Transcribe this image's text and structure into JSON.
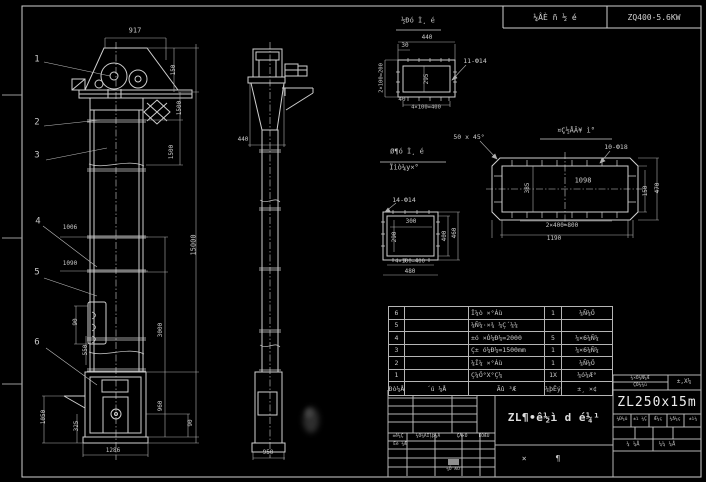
{
  "header": {
    "center_label": "¼ÂÈ ñ ½ é",
    "right_label": "ZQ400-5.6KW"
  },
  "titleblock": {
    "model": "ZL250x15m",
    "name": "ZL¶•ê½ì d é¼¹"
  },
  "bom": {
    "header": [
      "Ðò¼Å",
      "´ú ¼Å",
      "Ãû ³Æ",
      "¼þÊý",
      "±¸ ×¢"
    ],
    "rows": [
      [
        "6",
        "",
        "Î¼ò ×°Áù",
        "1",
        "¼Ñ¼Ö"
      ],
      [
        "5",
        "",
        "¼Ñ¼·×¾ ¼Ç´¼¼",
        "",
        ""
      ],
      [
        "4",
        "",
        "±ó ×Ó¼Ð¼=2000",
        "5",
        "¼×6¼Ñ¼"
      ],
      [
        "3",
        "",
        "Ç± ó¼Ð¼=1500mm",
        "1",
        "¼×6¼Ñ¼"
      ],
      [
        "2",
        "",
        "¼Î¼ ×°Áù",
        "1",
        "¼Ñ¼Ö"
      ],
      [
        "1",
        "",
        "Ç¼Ö°X°Ç¼",
        "1X",
        "¼ó¼Æ°"
      ]
    ]
  },
  "labels": [
    {
      "n": "dim-917",
      "t": "917",
      "x": 135,
      "y": 31,
      "s": 7
    },
    {
      "n": "dim-150",
      "t": "150",
      "x": 174,
      "y": 70,
      "r": 1,
      "s": 6
    },
    {
      "n": "dim-1500-a",
      "t": "1500",
      "x": 180,
      "y": 108,
      "r": 1,
      "s": 6
    },
    {
      "n": "dim-1500-b",
      "t": "1500",
      "x": 172,
      "y": 152,
      "r": 1,
      "s": 6
    },
    {
      "n": "dim-15000",
      "t": "15000",
      "x": 194,
      "y": 245,
      "r": 1,
      "s": 7
    },
    {
      "n": "dim-3000",
      "t": "3000",
      "x": 161,
      "y": 330,
      "r": 1,
      "s": 6
    },
    {
      "n": "dim-960",
      "t": "960",
      "x": 161,
      "y": 406,
      "r": 1,
      "s": 6
    },
    {
      "n": "dim-90-boot",
      "t": "90",
      "x": 191,
      "y": 423,
      "r": 1,
      "s": 6
    },
    {
      "n": "dim-1006",
      "t": "1006",
      "x": 70,
      "y": 228,
      "s": 6
    },
    {
      "n": "dim-1090",
      "t": "1090",
      "x": 70,
      "y": 264,
      "s": 6
    },
    {
      "n": "dim-90-door",
      "t": "90",
      "x": 76,
      "y": 322,
      "r": 1,
      "s": 6
    },
    {
      "n": "dim-550",
      "t": "550",
      "x": 86,
      "y": 350,
      "r": 1,
      "s": 6
    },
    {
      "n": "dim-1050",
      "t": "1050",
      "x": 44,
      "y": 417,
      "r": 1,
      "s": 6
    },
    {
      "n": "dim-325",
      "t": "325",
      "x": 77,
      "y": 426,
      "r": 1,
      "s": 6
    },
    {
      "n": "dim-1286",
      "t": "1286",
      "x": 113,
      "y": 451,
      "s": 6
    },
    {
      "n": "dim-440-side",
      "t": "440",
      "x": 243,
      "y": 140,
      "s": 6
    },
    {
      "n": "dim-950",
      "t": "950",
      "x": 268,
      "y": 453,
      "s": 6
    },
    {
      "n": "dim-440-flange",
      "t": "440",
      "x": 427,
      "y": 38,
      "s": 6
    },
    {
      "n": "dim-30",
      "t": "30",
      "x": 405,
      "y": 46,
      "s": 6
    },
    {
      "n": "dim-2x100",
      "t": "2×100=200",
      "x": 382,
      "y": 78,
      "r": 1,
      "s": 5.5
    },
    {
      "n": "dim-295",
      "t": "295",
      "x": 427,
      "y": 79,
      "r": 1,
      "s": 6
    },
    {
      "n": "dim-40",
      "t": "40",
      "x": 402,
      "y": 100,
      "s": 6
    },
    {
      "n": "dim-4x100-a",
      "t": "4×100=400",
      "x": 426,
      "y": 108,
      "s": 5.5
    },
    {
      "n": "note-11-holes",
      "t": "11-Ф14",
      "x": 475,
      "y": 61,
      "s": 6.5
    },
    {
      "n": "note-14-holes",
      "t": "14-Ф14",
      "x": 404,
      "y": 200,
      "s": 6.5
    },
    {
      "n": "dim-300",
      "t": "300",
      "x": 411,
      "y": 222,
      "s": 6
    },
    {
      "n": "dim-290",
      "t": "290",
      "x": 395,
      "y": 237,
      "r": 1,
      "s": 6
    },
    {
      "n": "dim-400",
      "t": "400",
      "x": 445,
      "y": 236,
      "r": 1,
      "s": 6
    },
    {
      "n": "dim-460",
      "t": "460",
      "x": 455,
      "y": 233,
      "r": 1,
      "s": 6
    },
    {
      "n": "dim-4x100-b",
      "t": "4×100=400",
      "x": 410,
      "y": 262,
      "s": 5.5
    },
    {
      "n": "dim-480",
      "t": "480",
      "x": 410,
      "y": 272,
      "s": 6
    },
    {
      "n": "note-chamfer",
      "t": "50 x 45°",
      "x": 469,
      "y": 137,
      "s": 6.5
    },
    {
      "n": "note-10-holes",
      "t": "10-Ф18",
      "x": 616,
      "y": 147,
      "s": 6.5
    },
    {
      "n": "dim-1098",
      "t": "1098",
      "x": 583,
      "y": 181,
      "s": 7
    },
    {
      "n": "dim-385",
      "t": "385",
      "x": 528,
      "y": 188,
      "r": 1,
      "s": 6
    },
    {
      "n": "dim-150-inlet",
      "t": "150",
      "x": 646,
      "y": 191,
      "r": 1,
      "s": 6
    },
    {
      "n": "dim-470",
      "t": "470",
      "x": 658,
      "y": 188,
      "r": 1,
      "s": 6
    },
    {
      "n": "dim-2x400",
      "t": "2×400=800",
      "x": 562,
      "y": 226,
      "s": 6
    },
    {
      "n": "dim-1190",
      "t": "1190",
      "x": 554,
      "y": 239,
      "s": 6
    },
    {
      "n": "balloon-1",
      "t": "1",
      "x": 37,
      "y": 60,
      "s": 9
    },
    {
      "n": "balloon-2",
      "t": "2",
      "x": 37,
      "y": 123,
      "s": 9
    },
    {
      "n": "balloon-3",
      "t": "3",
      "x": 37,
      "y": 156,
      "s": 9
    },
    {
      "n": "balloon-4",
      "t": "4",
      "x": 38,
      "y": 222,
      "s": 9
    },
    {
      "n": "balloon-5",
      "t": "5",
      "x": 37,
      "y": 273,
      "s": 9
    },
    {
      "n": "balloon-6",
      "t": "6",
      "x": 37,
      "y": 343,
      "s": 9
    },
    {
      "n": "view-title-discharge",
      "t": "½Ðó Ì¸ é",
      "x": 418,
      "y": 21,
      "s": 7
    },
    {
      "n": "view-title-square-1",
      "t": "Ø¶ó Ì¸ é",
      "x": 407,
      "y": 152,
      "s": 7
    },
    {
      "n": "view-title-square-2",
      "t": "Ïìò¼y×°",
      "x": 404,
      "y": 168,
      "s": 7
    },
    {
      "n": "view-title-inlet",
      "t": "¤Ç½ÅÃ¥ ì°",
      "x": 576,
      "y": 131,
      "s": 7
    },
    {
      "n": "tb-cell-top-1",
      "t": "¼×Ö¼Ñ¼Æ",
      "x": 640,
      "y": 379,
      "s": 4.5
    },
    {
      "n": "tb-cell-top-2",
      "t": "ÇÕ¼¼ù",
      "x": 640,
      "y": 386,
      "s": 4.5
    },
    {
      "n": "tb-cell-top-3",
      "t": "±,X¼",
      "x": 684,
      "y": 382,
      "s": 6
    },
    {
      "n": "tb-small-1",
      "t": "¼Ð¼û",
      "x": 622,
      "y": 420,
      "s": 4.5
    },
    {
      "n": "tb-small-2",
      "t": "±ì ¼Ç",
      "x": 640,
      "y": 420,
      "s": 4.5
    },
    {
      "n": "tb-small-3",
      "t": "Ǽ¼ç",
      "x": 658,
      "y": 420,
      "s": 4.5
    },
    {
      "n": "tb-small-4",
      "t": "¼å¼ç",
      "x": 675,
      "y": 420,
      "s": 4.5
    },
    {
      "n": "tb-small-5",
      "t": "±ì¼",
      "x": 693,
      "y": 420,
      "s": 4.5
    },
    {
      "n": "tb-sheet-total",
      "t": "¼ ¼Å",
      "x": 633,
      "y": 445,
      "s": 5.5
    },
    {
      "n": "tb-sheet-no",
      "t": "¼¼ ¼Å",
      "x": 667,
      "y": 445,
      "s": 5.5
    },
    {
      "n": "tb-rev-1",
      "t": "±ê¼Ç",
      "x": 398,
      "y": 437,
      "s": 4.5
    },
    {
      "n": "tb-rev-2",
      "t": "¼Ö¼ÄÎļþ¼Å",
      "x": 428,
      "y": 437,
      "s": 4.5
    },
    {
      "n": "tb-rev-3",
      "t": "ÇÅ×Ö",
      "x": 462,
      "y": 437,
      "s": 4.5
    },
    {
      "n": "tb-rev-4",
      "t": "ÈÕÆÚ",
      "x": 484,
      "y": 437,
      "s": 4.5
    },
    {
      "n": "tb-design",
      "t": "Éè ¼Æ",
      "x": 400,
      "y": 445,
      "s": 4.5
    },
    {
      "n": "tb-date",
      "t": "¼Õ ÆÚ",
      "x": 453,
      "y": 470,
      "s": 4.5
    },
    {
      "n": "tb-assembly",
      "t": "×      ¶",
      "x": 541,
      "y": 459,
      "s": 8
    }
  ]
}
